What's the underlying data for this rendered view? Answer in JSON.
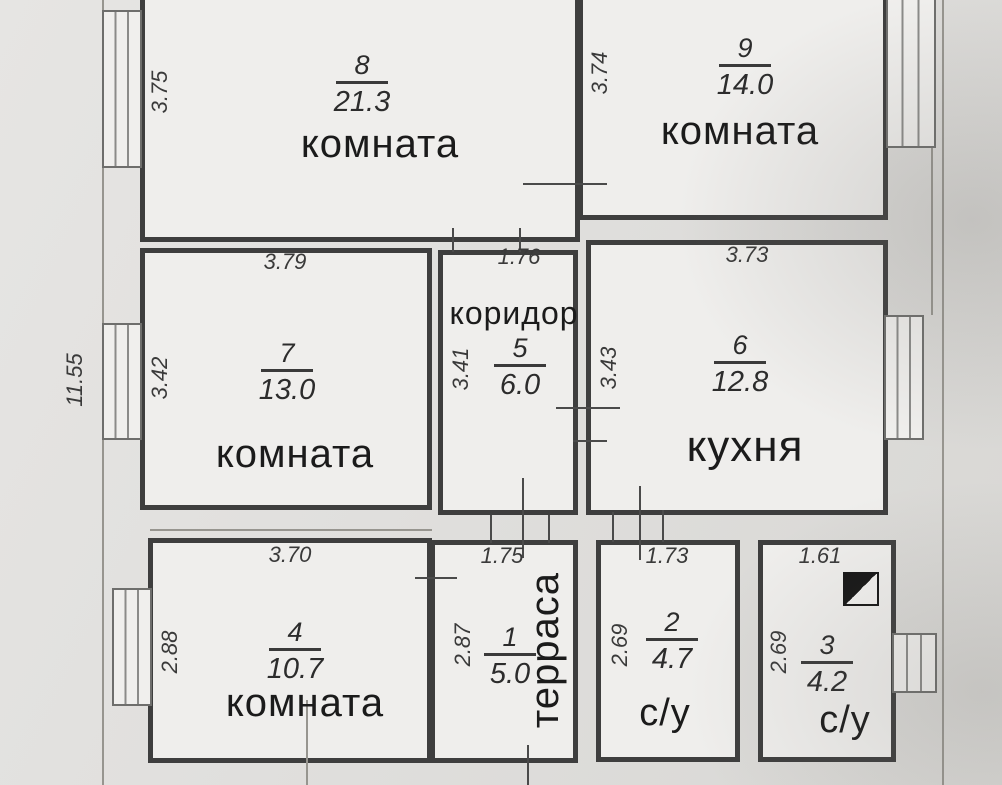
{
  "plan": {
    "type": "apartment-floor-plan",
    "language": "ru",
    "overall_height": "11.55",
    "rooms": [
      {
        "number": "1",
        "label": "терраса",
        "area": "5.0",
        "width_dim": "1.75",
        "height_dim": "2.87"
      },
      {
        "number": "2",
        "label": "с/у",
        "area": "4.7",
        "width_dim": "1.73",
        "height_dim": "2.69"
      },
      {
        "number": "3",
        "label": "с/у",
        "area": "4.2",
        "width_dim": "1.61",
        "height_dim": "2.69"
      },
      {
        "number": "4",
        "label": "комната",
        "area": "10.7",
        "width_dim": "3.70",
        "height_dim": "2.88"
      },
      {
        "number": "5",
        "label": "коридор",
        "area": "6.0",
        "width_dim": "1.76",
        "height_dim": "3.41"
      },
      {
        "number": "6",
        "label": "кухня",
        "area": "12.8",
        "width_dim": "3.73",
        "height_dim": "3.43"
      },
      {
        "number": "7",
        "label": "комната",
        "area": "13.0",
        "width_dim": "3.79",
        "height_dim": "3.42"
      },
      {
        "number": "8",
        "label": "комната",
        "area": "21.3",
        "height_dim": "3.75"
      },
      {
        "number": "9",
        "label": "комната",
        "area": "14.0",
        "height_dim": "3.74"
      }
    ],
    "symbols": {
      "entry_marker": "half-filled-square",
      "window": "double-line-rect"
    },
    "colors": {
      "wall": "#3e3e3e",
      "paper": "#dfdedc",
      "room_bg": "#efeeec",
      "text": "#1b1b1b"
    }
  }
}
